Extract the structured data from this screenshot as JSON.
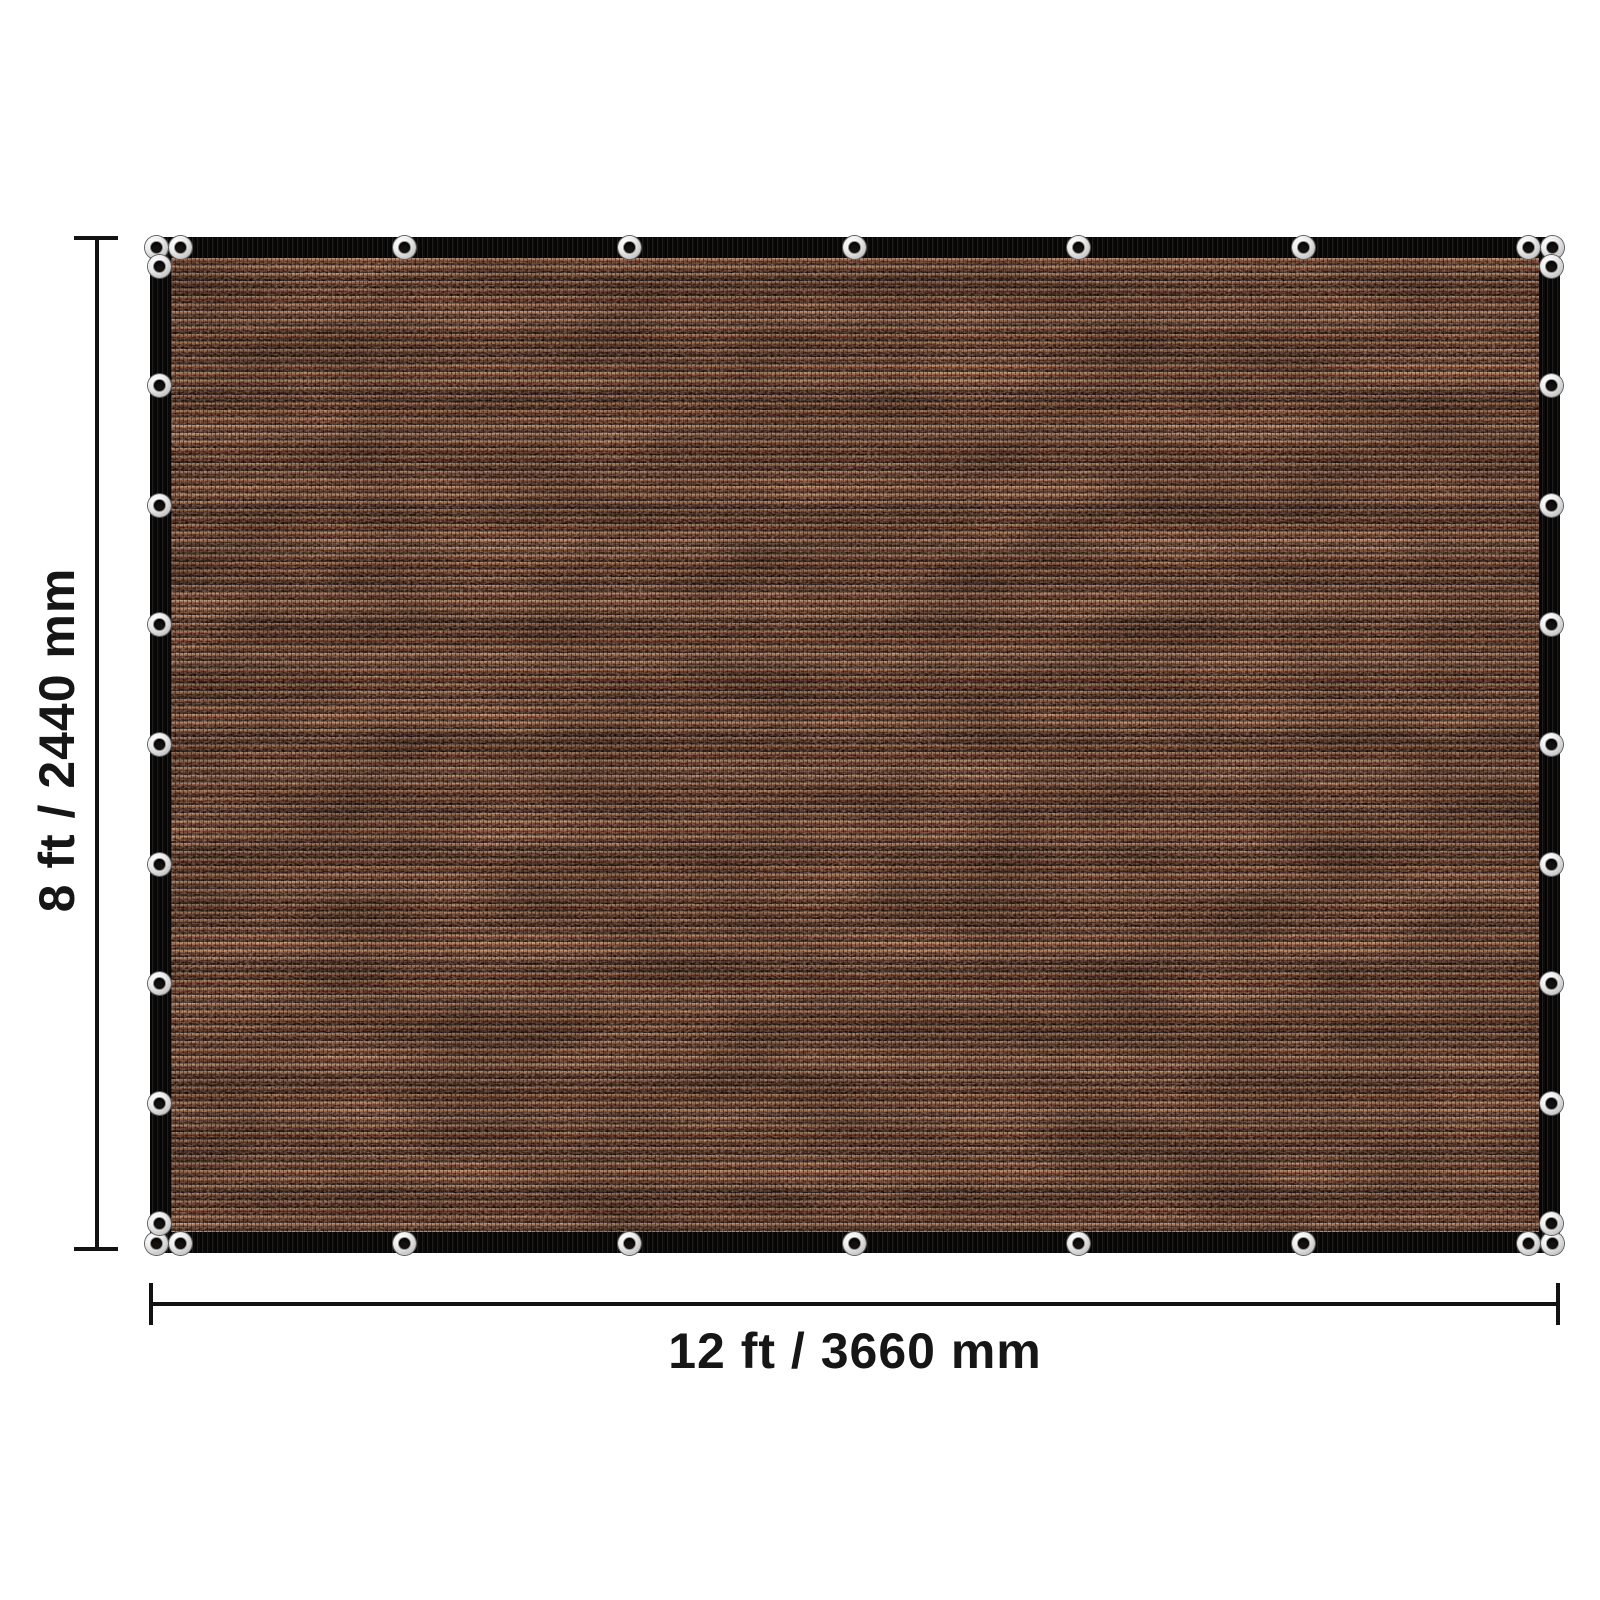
{
  "diagram": {
    "height_label": "8 ft / 2440 mm",
    "width_label": "12 ft / 3660 mm",
    "grommets": {
      "top": 9,
      "bottom": 9,
      "left": 9,
      "right": 9
    },
    "colors": {
      "page_background": "#ffffff",
      "dimension_lines": "#121212",
      "label_text": "#161616",
      "border_webbing": "#0b0a09",
      "fabric_base": "#241109",
      "fabric_highlight": "#c49a78",
      "fabric_rust": "#93513a",
      "fabric_dark_row": "#200e07",
      "grommet_ring": "#ececec",
      "grommet_hole": "#161210"
    }
  }
}
